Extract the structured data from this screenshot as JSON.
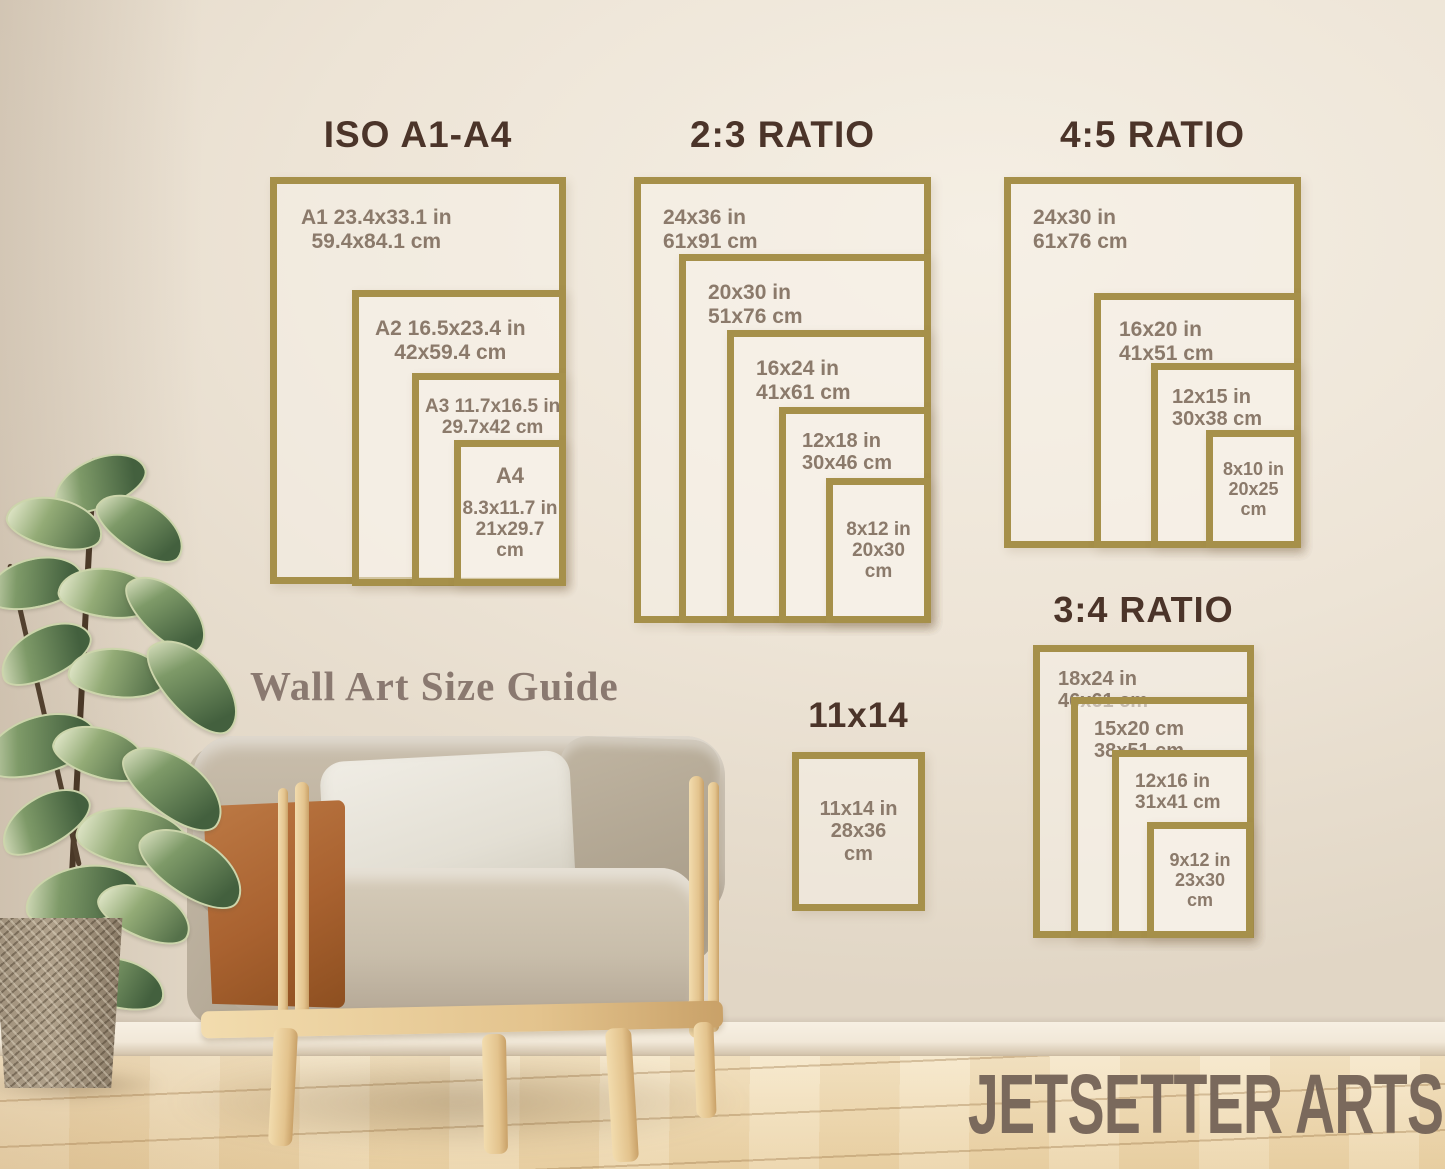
{
  "scene": {
    "caption": "Wall Art Size Guide",
    "brand": "JETSETTER ARTS"
  },
  "colors": {
    "frame_gold": "#a6904a",
    "title_brown": "#4b3429",
    "label_brown": "#8b7a6b",
    "caption_brown": "#8a7970",
    "brand_brown": "#7a695c",
    "wall_cream": "#ede4d6",
    "floor_wood": "#efdab3"
  },
  "groups": [
    {
      "title": "ISO A1-A4",
      "frames": [
        {
          "lines": [
            "A1 23.4x33.1 in",
            "59.4x84.1 cm"
          ]
        },
        {
          "lines": [
            "A2 16.5x23.4 in",
            "42x59.4 cm"
          ]
        },
        {
          "lines": [
            "A3 11.7x16.5 in",
            "29.7x42 cm"
          ]
        },
        {
          "name": "A4",
          "lines": [
            "8.3x11.7 in",
            "21x29.7",
            "cm"
          ]
        }
      ]
    },
    {
      "title": "2:3 RATIO",
      "frames": [
        {
          "lines": [
            "24x36 in",
            "61x91 cm"
          ]
        },
        {
          "lines": [
            "20x30 in",
            "51x76 cm"
          ]
        },
        {
          "lines": [
            "16x24 in",
            "41x61 cm"
          ]
        },
        {
          "lines": [
            "12x18 in",
            "30x46 cm"
          ]
        },
        {
          "lines": [
            "8x12 in",
            "20x30",
            "cm"
          ]
        }
      ]
    },
    {
      "title": "4:5 RATIO",
      "frames": [
        {
          "lines": [
            "24x30 in",
            "61x76 cm"
          ]
        },
        {
          "lines": [
            "16x20 in",
            "41x51 cm"
          ]
        },
        {
          "lines": [
            "12x15 in",
            "30x38 cm"
          ]
        },
        {
          "lines": [
            "8x10 in",
            "20x25",
            "cm"
          ]
        }
      ]
    },
    {
      "title": "3:4 RATIO",
      "frames": [
        {
          "lines": [
            "18x24 in",
            "46x61 cm"
          ]
        },
        {
          "lines": [
            "15x20 cm",
            "38x51 cm"
          ]
        },
        {
          "lines": [
            "12x16 in",
            "31x41 cm"
          ]
        },
        {
          "lines": [
            "9x12 in",
            "23x30",
            "cm"
          ]
        }
      ]
    },
    {
      "title": "11x14",
      "frames": [
        {
          "lines": [
            "11x14 in",
            "28x36",
            "cm"
          ]
        }
      ]
    }
  ]
}
